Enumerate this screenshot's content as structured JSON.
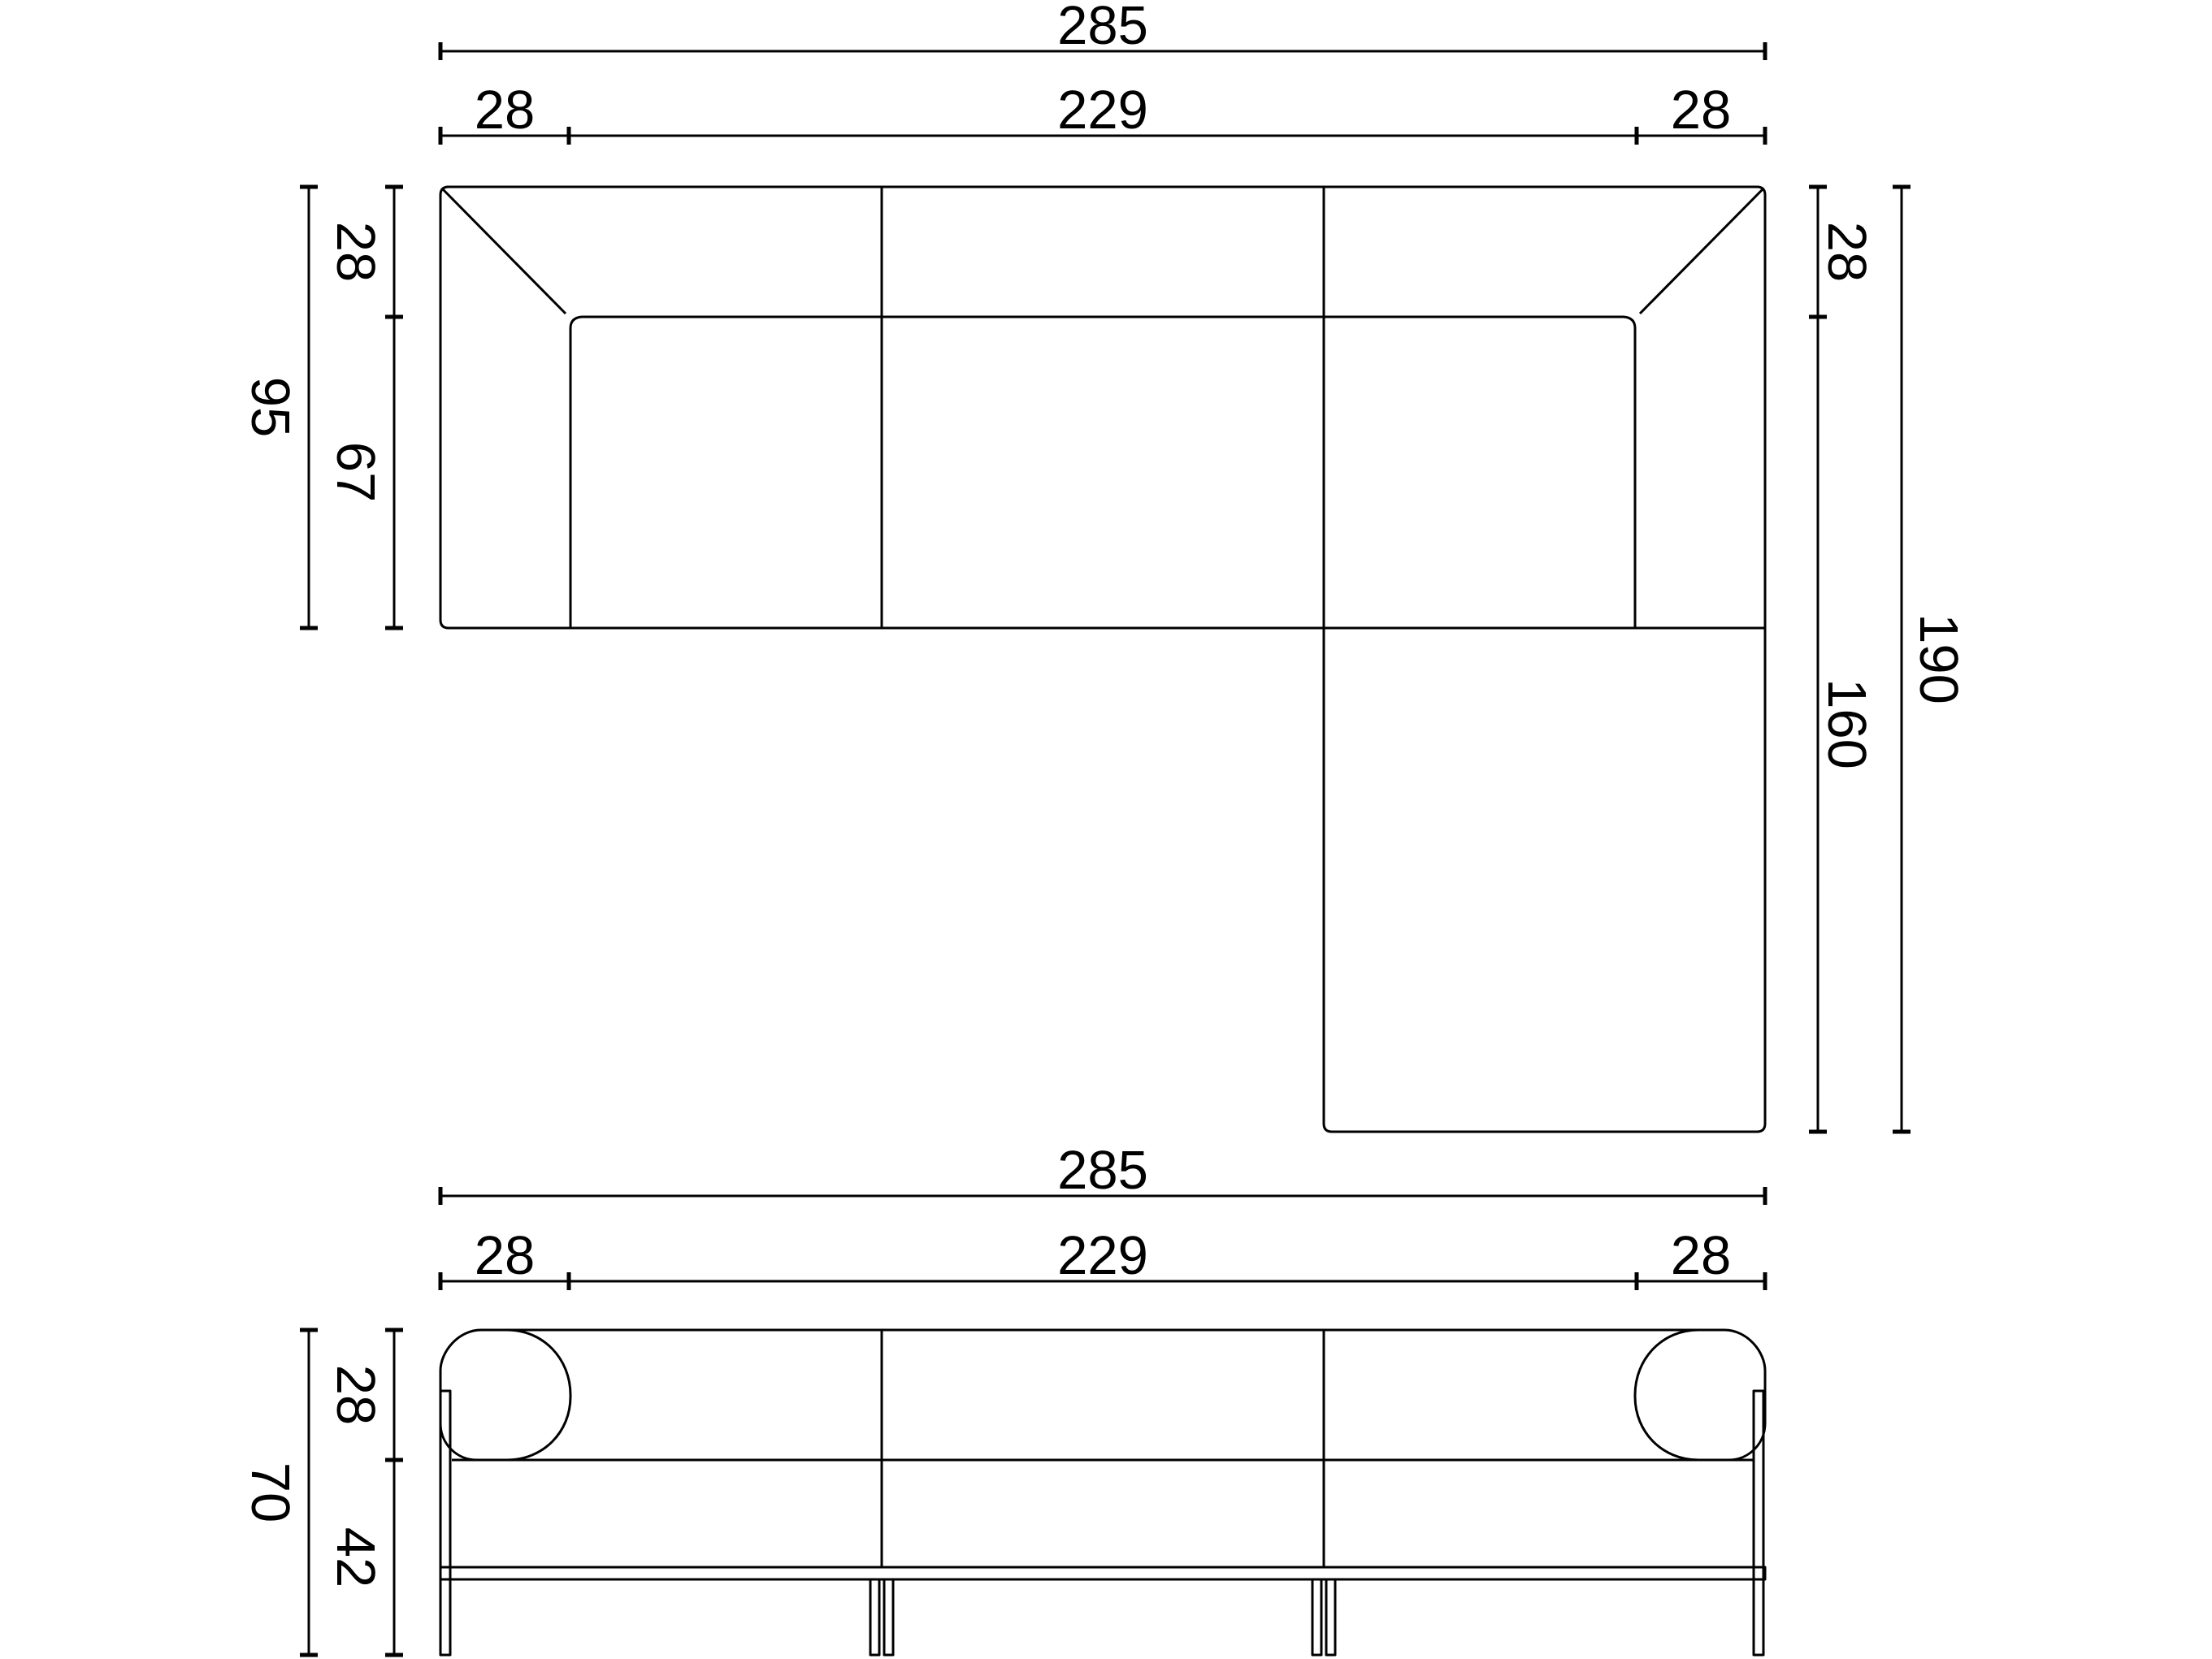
{
  "top_view": {
    "width_dims": {
      "overall": "285",
      "left_armrest": "28",
      "inner_span": "229",
      "right_armrest": "28"
    },
    "depth_dims_left": {
      "overall": "95",
      "backrest": "28",
      "seat": "67"
    },
    "depth_dims_right": {
      "backrest": "28",
      "chaise": "160",
      "overall": "190"
    }
  },
  "front_view": {
    "width_dims": {
      "overall": "285",
      "left_armrest": "28",
      "inner_span": "229",
      "right_armrest": "28"
    },
    "height_dims": {
      "overall": "70",
      "backrest": "28",
      "base": "42"
    }
  }
}
